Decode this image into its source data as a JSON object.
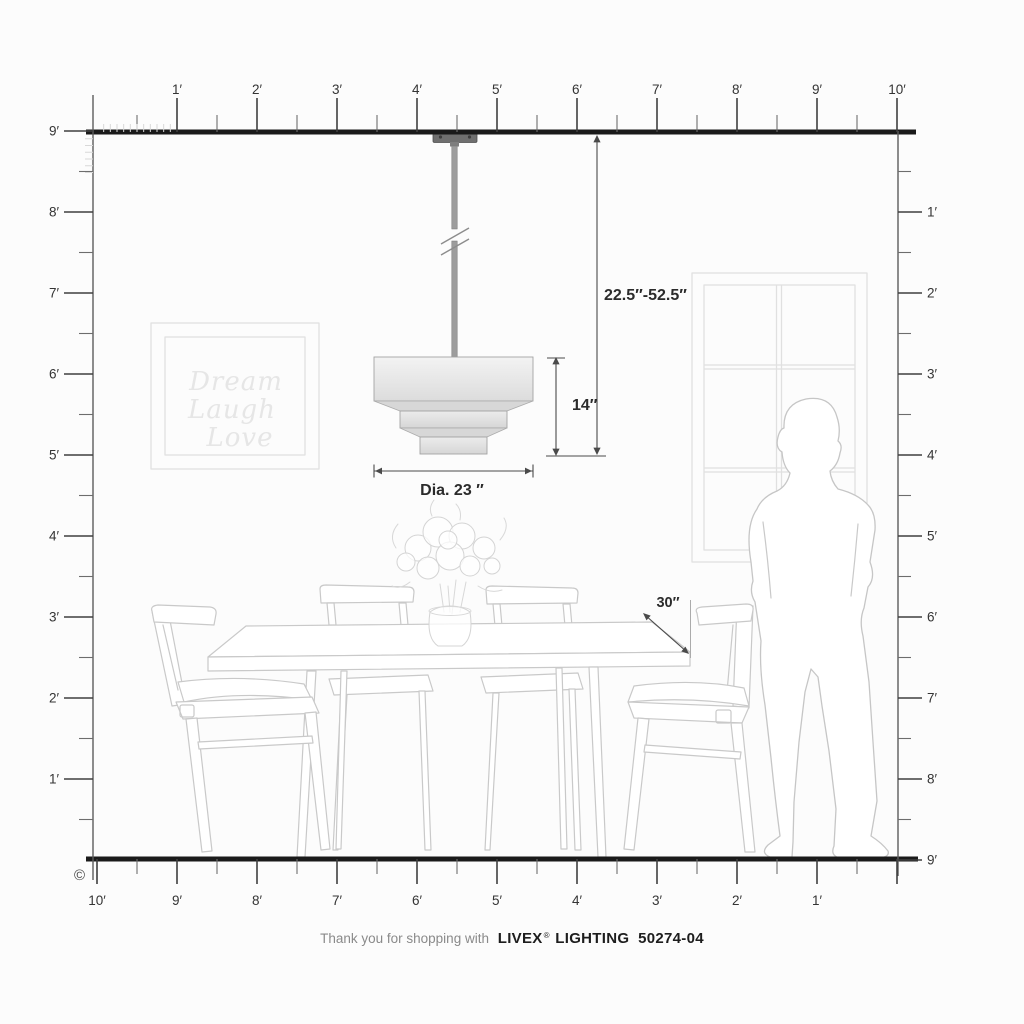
{
  "footer": {
    "thank_you": "Thank you for shopping with",
    "brand": "LIVEX",
    "registered_mark": "®",
    "product_line": "LIGHTING",
    "model_number": "50274-04"
  },
  "copyright_symbol": "©",
  "rulers": {
    "top": {
      "labels": [
        "1′",
        "2′",
        "3′",
        "4′",
        "5′",
        "6′",
        "7′",
        "8′",
        "9′",
        "10′"
      ]
    },
    "bottom": {
      "labels": [
        "10′",
        "9′",
        "8′",
        "7′",
        "6′",
        "5′",
        "4′",
        "3′",
        "2′",
        "1′"
      ]
    },
    "left": {
      "labels": [
        "9′",
        "8′",
        "7′",
        "6′",
        "5′",
        "4′",
        "3′",
        "2′",
        "1′"
      ]
    },
    "right": {
      "labels": [
        "1′",
        "2′",
        "3′",
        "4′",
        "5′",
        "6′",
        "7′",
        "8′",
        "9′"
      ]
    }
  },
  "dimensions": {
    "suspension_range": "22.5″-52.5″",
    "fixture_height": "14″",
    "fixture_diameter": "Dia. 23 ″",
    "table_surface": "30″"
  },
  "wall_art": {
    "line1": "Dream",
    "line2": "Laugh",
    "line3": "Love"
  },
  "colors": {
    "ruler_ink": "#1a1a1a",
    "dimension_ink": "#2b2b2b",
    "sketch_line": "#c9c9c9",
    "shade_fill_top": "#f2f2f2",
    "shade_fill_bottom": "#dadada"
  }
}
